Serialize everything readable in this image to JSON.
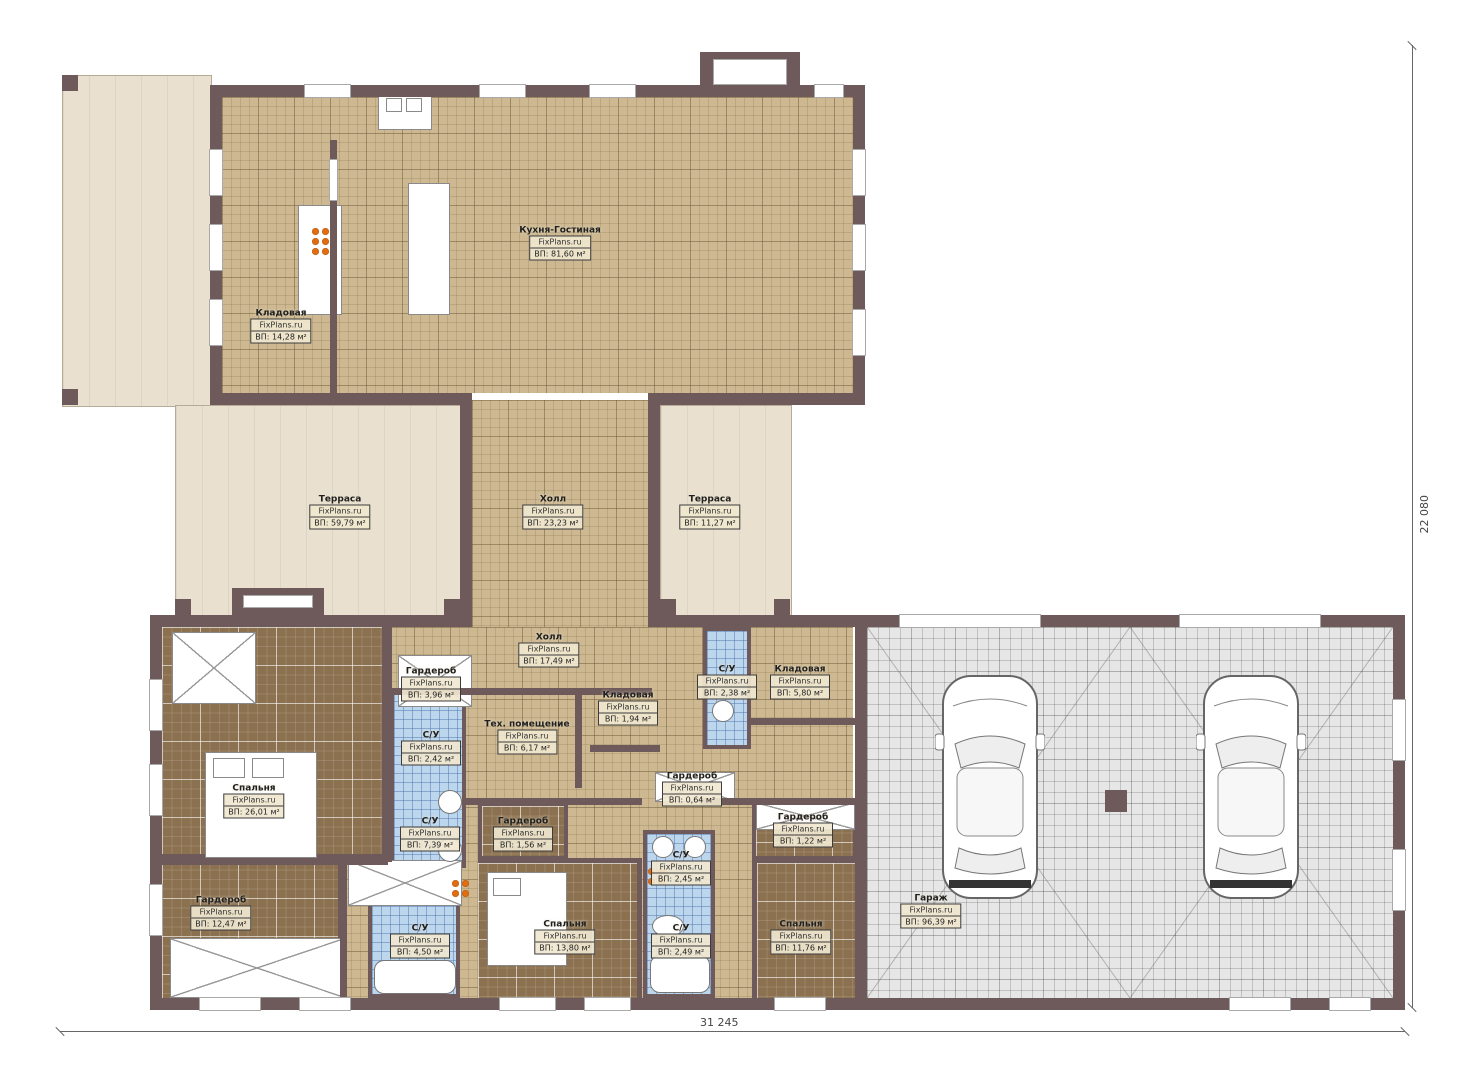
{
  "plan": {
    "watermark": "FixPlans.ru",
    "rooms": [
      {
        "name": "Кухня-Гостиная",
        "area": "ВП: 81,60 м²"
      },
      {
        "name": "Кладовая",
        "area": "ВП: 14,28 м²"
      },
      {
        "name": "Терраса",
        "area": "ВП: 59,79 м²"
      },
      {
        "name": "Холл",
        "area": "ВП: 23,23 м²"
      },
      {
        "name": "Терраса",
        "area": "ВП: 11,27 м²"
      },
      {
        "name": "Холл",
        "area": "ВП: 17,49 м²"
      },
      {
        "name": "Гардероб",
        "area": "ВП: 3,96 м²"
      },
      {
        "name": "С/У",
        "area": "ВП: 2,38 м²"
      },
      {
        "name": "Кладовая",
        "area": "ВП: 5,80 м²"
      },
      {
        "name": "Кладовая",
        "area": "ВП: 1,94 м²"
      },
      {
        "name": "Тех. помещение",
        "area": "ВП: 6,17 м²"
      },
      {
        "name": "С/У",
        "area": "ВП: 2,42 м²"
      },
      {
        "name": "Спальня",
        "area": "ВП: 26,01 м²"
      },
      {
        "name": "С/У",
        "area": "ВП: 7,39 м²"
      },
      {
        "name": "Гардероб",
        "area": "ВП: 1,56 м²"
      },
      {
        "name": "Гардероб",
        "area": "ВП: 0,64 м²"
      },
      {
        "name": "Гардероб",
        "area": "ВП: 1,22 м²"
      },
      {
        "name": "Гардероб",
        "area": "ВП: 12,47 м²"
      },
      {
        "name": "С/У",
        "area": "ВП: 4,50 м²"
      },
      {
        "name": "Спальня",
        "area": "ВП: 13,80 м²"
      },
      {
        "name": "С/У",
        "area": "ВП: 2,45 м²"
      },
      {
        "name": "С/У",
        "area": "ВП: 2,49 м²"
      },
      {
        "name": "Спальня",
        "area": "ВП: 11,76 м²"
      },
      {
        "name": "Гараж",
        "area": "ВП: 96,39 м²"
      }
    ],
    "dimensions": {
      "width_label": "31 245",
      "height_label": "22 080"
    },
    "colors": {
      "wall": "#6e5a5a",
      "floor_tan": "#cdb892",
      "floor_brown": "#8b7150",
      "floor_blue": "#bcd6ee",
      "floor_gray": "#e6e6e6",
      "terrace": "#e9e0cf",
      "burner_orange": "#e06d12"
    }
  }
}
